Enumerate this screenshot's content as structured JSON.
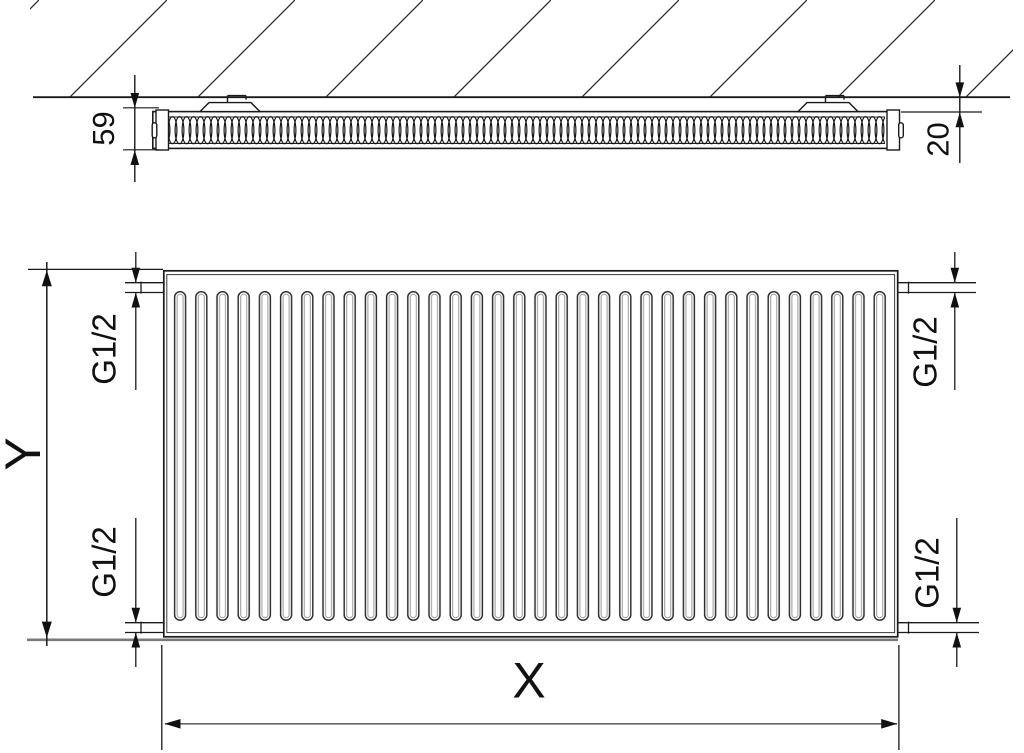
{
  "side_view": {
    "depth_label": "59",
    "wall_gap_label": "20"
  },
  "front_view": {
    "height_label": "Y",
    "width_label": "X",
    "connection_top_left": "G1/2",
    "connection_top_right": "G1/2",
    "connection_bottom_left": "G1/2",
    "connection_bottom_right": "G1/2"
  },
  "colors": {
    "line": "#1a1a1a",
    "shadow": "#7a7a7a"
  }
}
